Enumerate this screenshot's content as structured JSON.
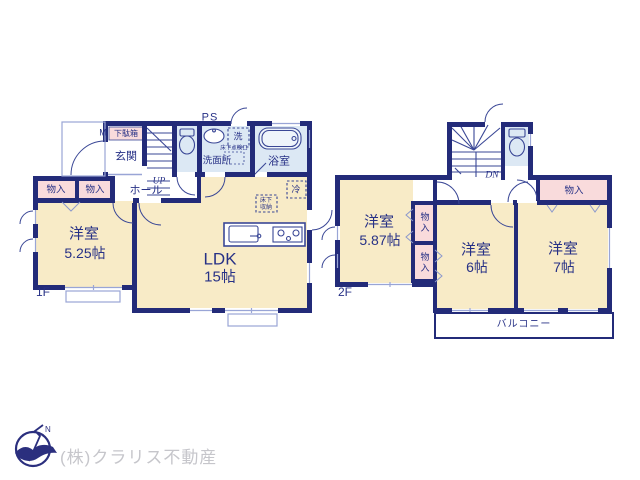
{
  "plan_title": "2-story residential floor plan",
  "colors": {
    "wall": "#232b79",
    "room_cream": "#f8ebc7",
    "room_blue": "#dce8f4",
    "room_pink": "#f9dbdc",
    "fixture_line": "#3a4796",
    "light_line": "#99a5d6",
    "label_text": "#273186",
    "company_text": "#c6c6cb"
  },
  "floor1": {
    "label": "1F",
    "ps": "PS",
    "shoebox_m": "M",
    "shoebox": "下駄箱",
    "entrance": "玄関",
    "washer": "洗",
    "inspection_port": "床下点検口",
    "washroom": "洗面所",
    "bathroom": "浴室",
    "up": "UP",
    "hall": "ホール",
    "storage_a": "物入",
    "storage_b": "物入",
    "western_room_name": "洋室",
    "western_room_size": "5.25帖",
    "ldk_name": "LDK",
    "ldk_size": "15帖",
    "fridge": "冷",
    "underfloor_line1": "床下",
    "underfloor_line2": "収納"
  },
  "floor2": {
    "label": "2F",
    "dn": "DN",
    "closet_top": "物入",
    "closet_a": "物入",
    "closet_b": "物入",
    "west1_name": "洋室",
    "west1_size": "5.87帖",
    "west2_name": "洋室",
    "west2_size": "6帖",
    "west3_name": "洋室",
    "west3_size": "7帖",
    "balcony": "バルコニー"
  },
  "footer": {
    "company": "(株)クラリス不動産",
    "north": "N"
  }
}
